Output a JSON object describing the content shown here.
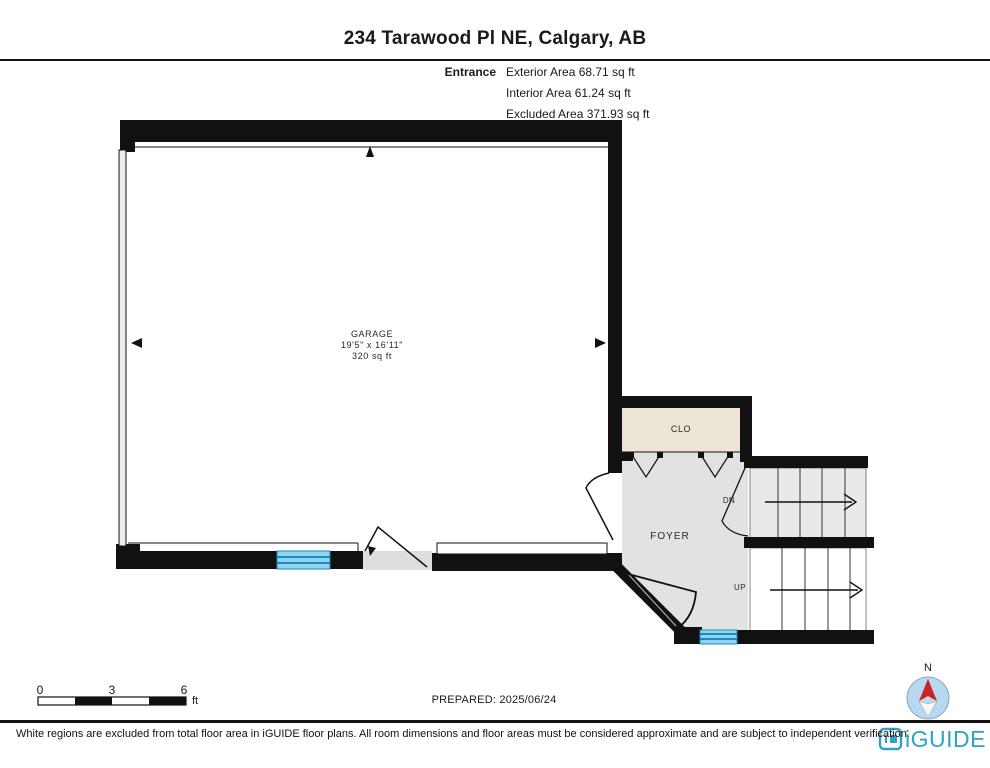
{
  "page": {
    "title": "234 Tarawood Pl NE, Calgary, AB"
  },
  "floor_info": {
    "floor_label": "Entrance",
    "exterior_area": "Exterior Area 68.71 sq ft",
    "interior_area": "Interior Area 61.24 sq ft",
    "excluded_area": "Excluded Area 371.93 sq ft"
  },
  "rooms": {
    "garage": {
      "name": "GARAGE",
      "dimensions": "19'5\" x 16'11\"",
      "area": "320 sq ft"
    },
    "closet": {
      "name": "CLO"
    },
    "foyer": {
      "name": "FOYER"
    },
    "stair_down": {
      "label": "DN"
    },
    "stair_up": {
      "label": "UP"
    }
  },
  "scale_bar": {
    "tick_0": "0",
    "tick_3": "3",
    "tick_6": "6",
    "unit": "ft"
  },
  "prepared_label": "PREPARED: 2025/06/24",
  "compass": {
    "north_label": "N"
  },
  "footer": {
    "disclaimer": "White regions are excluded from total floor area in iGUIDE floor plans. All room dimensions and floor areas must be considered approximate and are subject to independent verification.",
    "brand": "iGUIDE"
  },
  "colors": {
    "wall": "#111111",
    "foyer_fill": "#e2e2e2",
    "closet_fill": "#ece4d4",
    "stair_down_fill": "#e9e9e9",
    "window_fill": "#8fd4f0",
    "window_line": "#1e88b8",
    "accent_teal": "#2fa3c2",
    "compass_blue": "#b7d8f0",
    "compass_red": "#cc2222"
  }
}
